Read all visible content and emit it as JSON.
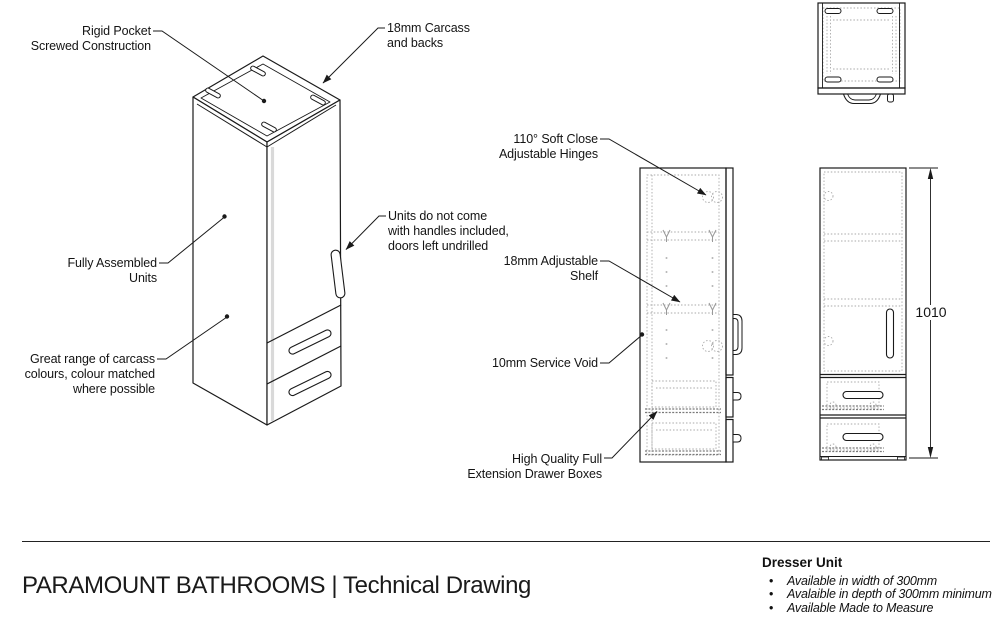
{
  "annotations": {
    "rigid_pocket": "Rigid Pocket\nScrewed Construction",
    "carcass": "18mm Carcass\nand backs",
    "fully_assembled": "Fully Assembled\nUnits",
    "no_handles": "Units do not come\nwith handles included,\ndoors left undrilled",
    "carcass_colours": "Great range of carcass\ncolours, colour matched\nwhere possible",
    "hinges": "110° Soft Close\nAdjustable Hinges",
    "shelf": "18mm Adjustable\nShelf",
    "service_void": "10mm Service Void",
    "drawer_boxes": "High Quality Full\nExtension Drawer Boxes"
  },
  "dimensions": {
    "height_mm": "1010"
  },
  "footer": {
    "title": "PARAMOUNT BATHROOMS | Technical Drawing",
    "product_name": "Dresser Unit",
    "bullets": [
      "Available in width of 300mm",
      "Avalaible in depth of 300mm minimum",
      "Available Made to Measure"
    ]
  },
  "colors": {
    "line": "#1a1a1a",
    "hidden_line": "#a9a9a9",
    "background": "#ffffff"
  }
}
